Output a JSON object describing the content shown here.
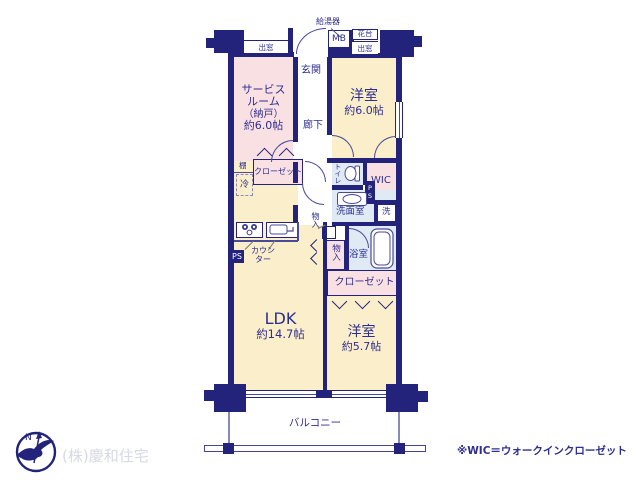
{
  "colors": {
    "wall": "#23237b",
    "text": "#2e2e8f",
    "room_pink": "#f9e0e3",
    "room_cream": "#fbeeca",
    "room_blue": "#dfeaf5",
    "footer_gray": "#d8d9e3"
  },
  "plan": {
    "entrance": {
      "label": "玄関"
    },
    "corridor": {
      "label": "廊下"
    },
    "service_room": {
      "line1": "サービス",
      "line2": "ルーム",
      "line3": "（納戸）",
      "line4": "約6.0帖"
    },
    "bedroom_6": {
      "label": "洋室",
      "size": "約6.0帖"
    },
    "bedroom_57": {
      "label": "洋室",
      "size": "約5.7帖"
    },
    "ldk": {
      "label": "LDK",
      "size": "約14.7帖"
    },
    "balcony": {
      "label": "バルコニー"
    },
    "toilet": {
      "label": "トイレ"
    },
    "wic": {
      "label": "WIC"
    },
    "washroom": {
      "label": "洗面室"
    },
    "washer": {
      "label": "洗"
    },
    "bathroom": {
      "label": "浴室"
    },
    "closet_service": {
      "label": "クローゼット"
    },
    "closet_main": {
      "label": "クローゼット"
    },
    "storage_upper": {
      "label": "物入"
    },
    "storage_lower": {
      "label": "物入"
    },
    "shelf": {
      "label": "棚"
    },
    "fridge": {
      "label": "冷"
    },
    "counter": {
      "line1": "カウン",
      "line2": "ター"
    },
    "water_heater": {
      "label": "給湯器"
    },
    "meter_box": {
      "label": "MB"
    },
    "flower_stand": {
      "label": "花台"
    },
    "bay_window_left": {
      "label": "出窓"
    },
    "bay_window_right": {
      "label": "出窓"
    },
    "ps_kitchen": {
      "label": "PS"
    },
    "ps_wic": {
      "label": "PS"
    }
  },
  "footer": {
    "company": "(株)慶和住宅",
    "note": "※WIC＝ウォークインクローゼット",
    "north": "N"
  }
}
